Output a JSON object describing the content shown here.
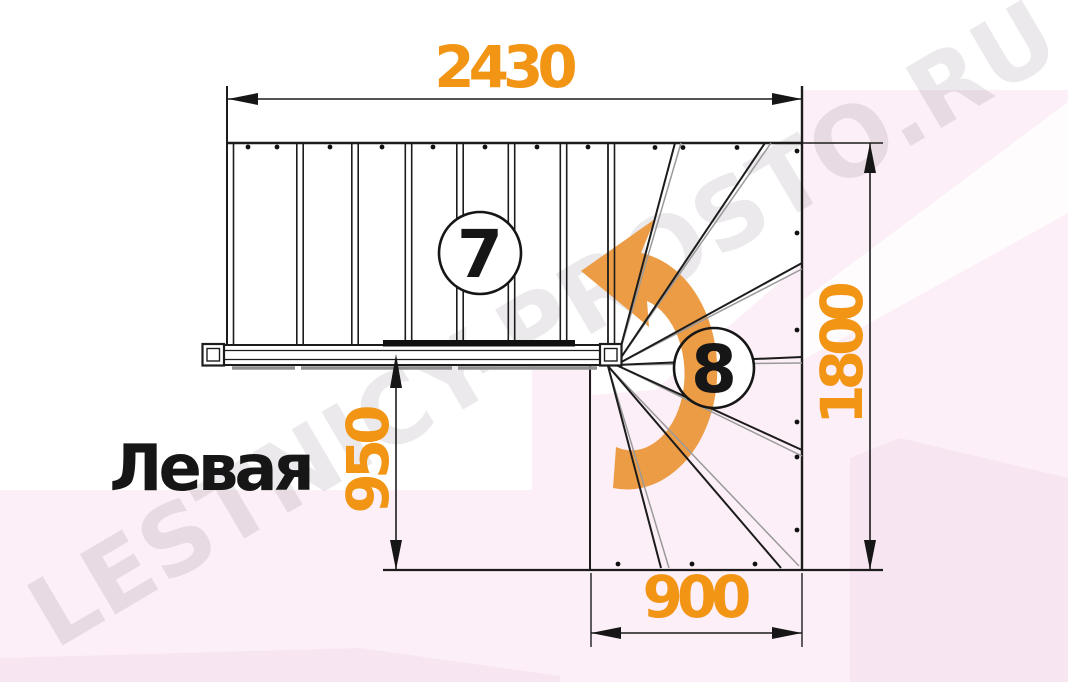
{
  "drawing": {
    "watermark_text": "LESTNICY-PROSTO.RU",
    "orientation_label": "Левая",
    "straight_flight_steps": "7",
    "winder_flight_steps": "8",
    "dim_top_mm": "2430",
    "dim_right_mm": "1800",
    "dim_left_mm": "950",
    "dim_bottom_mm": "900"
  },
  "colors": {
    "dimension_text": "#F29414",
    "turn_arrow": "#EC9C45",
    "linework": "#1C1C1C",
    "background_pink": "#FCEFF7",
    "background_pink_deep": "#F7E6F1",
    "watermark": "#40303F"
  }
}
